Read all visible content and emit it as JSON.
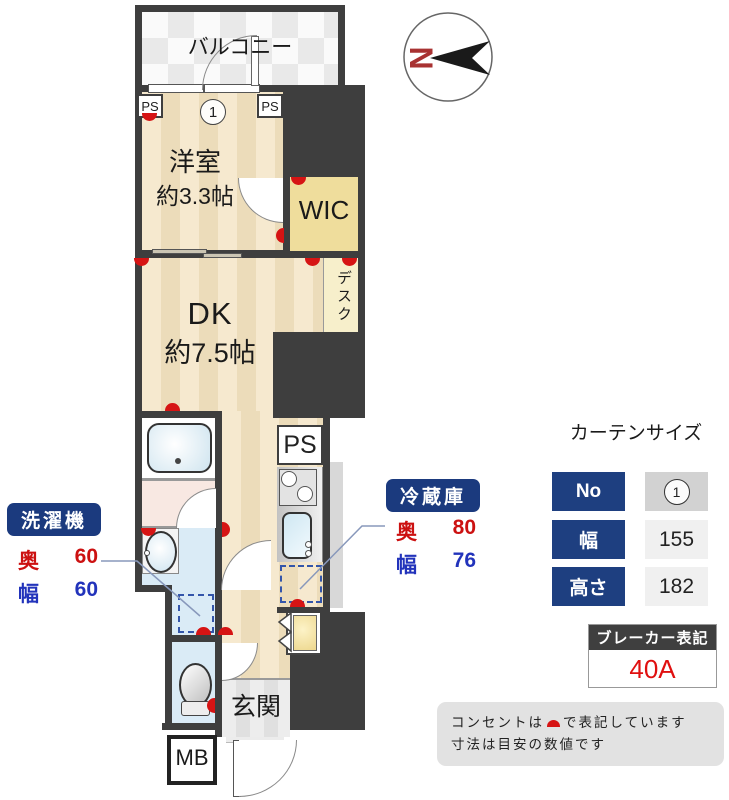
{
  "plan": {
    "balcony": "バルコニー",
    "north": "N",
    "ps": "PS",
    "room_number": "1",
    "western_room": {
      "name": "洋室",
      "size": "約3.3帖"
    },
    "wic": "WIC",
    "desk": "デスク",
    "dk": {
      "name": "DK",
      "size": "約7.5帖"
    },
    "entrance": "玄関",
    "meter_box": "MB"
  },
  "washer": {
    "title": "洗濯機",
    "depth_label": "奥",
    "depth_value": "60",
    "width_label": "幅",
    "width_value": "60"
  },
  "fridge": {
    "title": "冷蔵庫",
    "depth_label": "奥",
    "depth_value": "80",
    "width_label": "幅",
    "width_value": "76"
  },
  "curtain": {
    "title": "カーテンサイズ",
    "rows": [
      {
        "label": "No",
        "value": "1"
      },
      {
        "label": "幅",
        "value": "155"
      },
      {
        "label": "高さ",
        "value": "182"
      }
    ]
  },
  "breaker": {
    "title": "ブレーカー表記",
    "value": "40A"
  },
  "notes": {
    "line1_before": "コンセントは",
    "line1_after": "で表記しています",
    "line2": "寸法は目安の数値です"
  },
  "colors": {
    "wall": "#3E3E3E",
    "floor": "#F5E7CB",
    "wic": "#EFDD9C",
    "water": "#DAEBF6",
    "pink": "#F8E8E2",
    "navy": "#1B3A7E",
    "red": "#CC1111",
    "blue": "#2233BB",
    "outlet": "#D61414"
  }
}
